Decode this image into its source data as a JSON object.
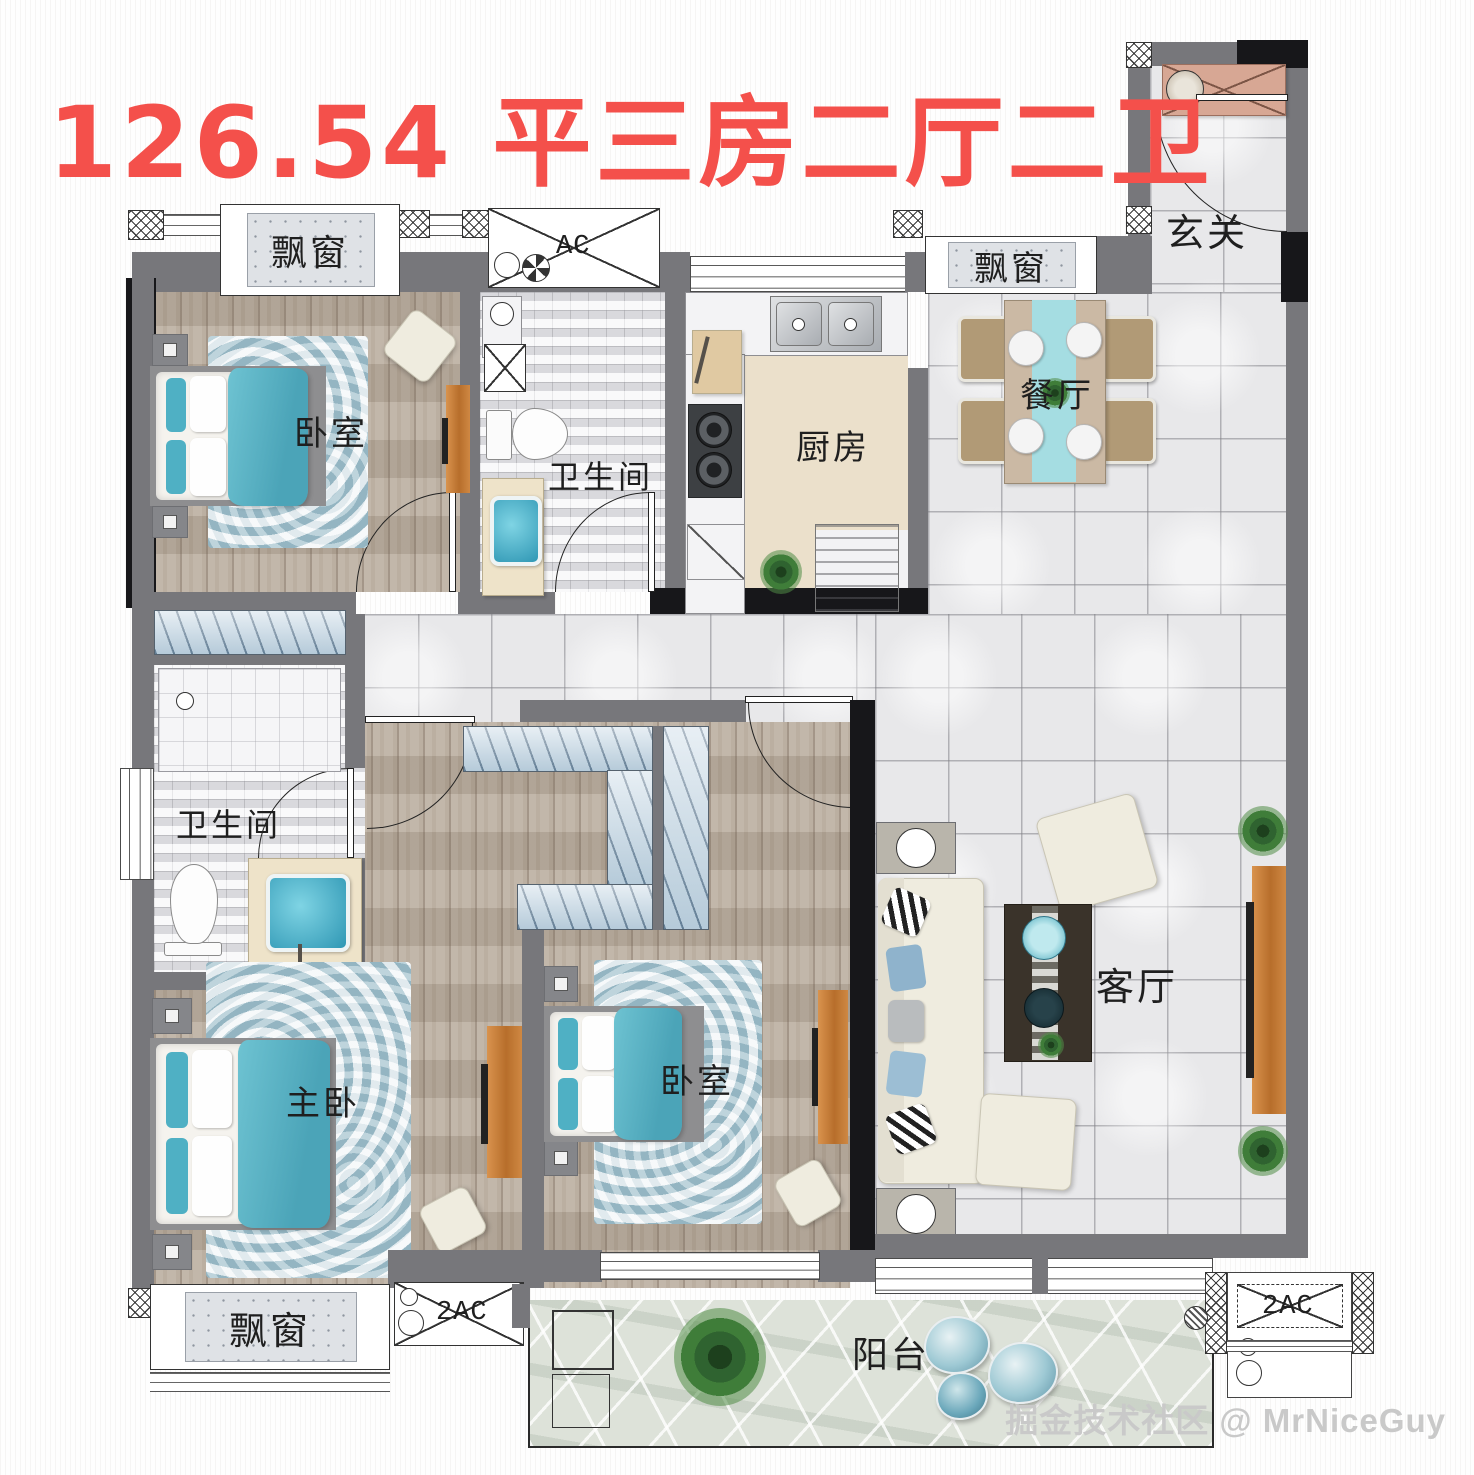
{
  "title": "126.54 平三房二厅二卫",
  "watermark": "掘金技术社区 @ MrNiceGuy",
  "rooms": {
    "entry": "玄关",
    "dining": "餐厅",
    "kitchen": "厨房",
    "bath_top": "卫生间",
    "bath_master": "卫生间",
    "bedroom_top": "卧室",
    "bedroom_second": "卧室",
    "master": "主卧",
    "living": "客厅",
    "balcony": "阳台"
  },
  "bay_windows": {
    "top_left": "飘窗",
    "top_right": "飘窗",
    "bottom_left": "飘窗"
  },
  "ac_units": {
    "top": "AC",
    "bottom_left": "2AC",
    "bottom_right": "2AC"
  },
  "colors": {
    "title_red": "#f4504b",
    "wall_gray": "#77777b",
    "wall_black": "#17171a",
    "teal_accent": "#4fb0c4",
    "wood_floor": "#b5a899",
    "tile_floor": "#e8e8ea",
    "orange_furniture": "#c5813f",
    "stone_floor": "#dde2d9"
  }
}
